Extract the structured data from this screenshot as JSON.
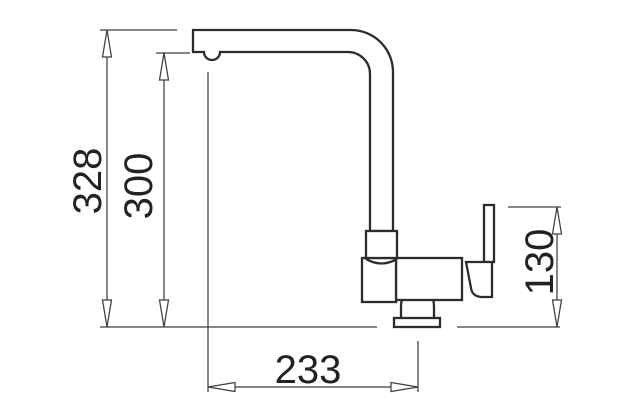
{
  "diagram": {
    "title": "kitchen-faucet-technical-drawing-side-view",
    "background": "#ffffff",
    "outline_color": "#2c2c2c",
    "dimension_color": "#3f3f3f",
    "text_color": "#222222",
    "dimensions": {
      "total_height": "328",
      "spout_outlet_height": "300",
      "handle_height": "130",
      "spout_reach": "233"
    }
  }
}
